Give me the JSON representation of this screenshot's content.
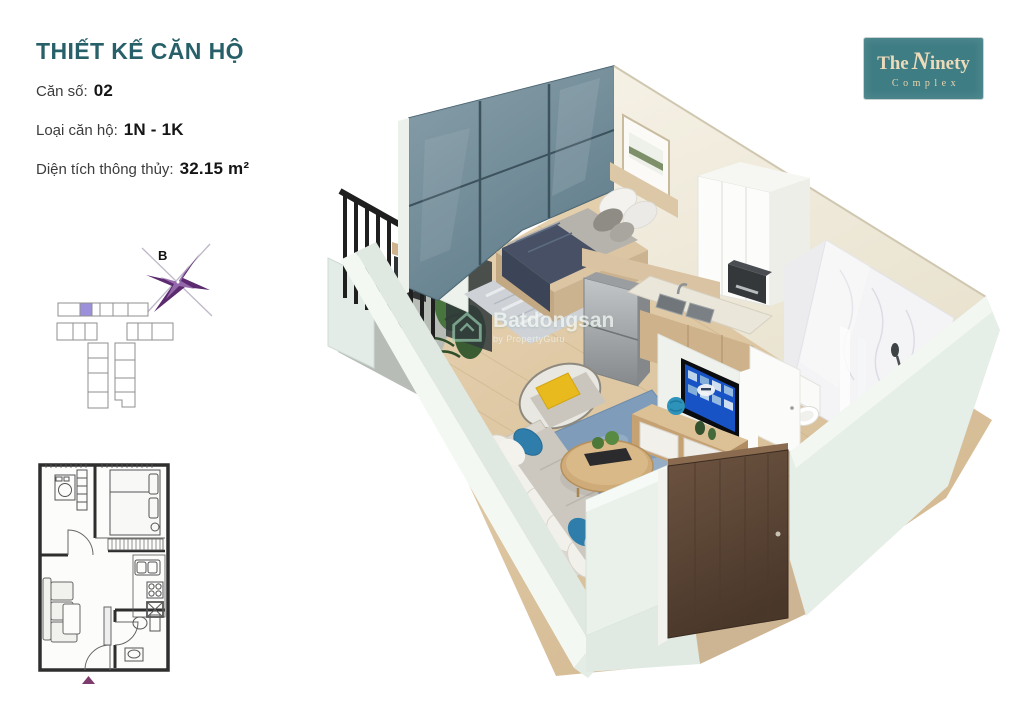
{
  "page": {
    "width": 1024,
    "height": 724,
    "background": "#ffffff"
  },
  "header": {
    "title": "THIẾT KẾ CĂN HỘ",
    "specs": [
      {
        "label": "Căn số:",
        "value": "02"
      },
      {
        "label": "Loại căn hộ:",
        "value": "1N - 1K"
      },
      {
        "label": "Diện tích thông thủy:",
        "value": "32.15 m²"
      }
    ]
  },
  "logo": {
    "word_the": "The",
    "word_ninety_initial": "N",
    "word_ninety_rest": "inety",
    "word_complex": "Complex"
  },
  "key_plan": {
    "compass_label": "B"
  },
  "watermark": {
    "brand": "Batdongsan",
    "byline": "by PropertyGuru"
  },
  "colors": {
    "title_teal": "#28606A",
    "logo_background": "#3F7D84",
    "logo_text_gold": "#ECDBBA",
    "keyplan_highlight_purple": "#9C90DA",
    "compass_purple": "#5C2A6E",
    "entry_arrow_purple": "#7D3C6E",
    "glass_wall": "#75909D",
    "outer_wall_mint": "#E6EFE9",
    "back_wall_cream": "#F2EEE2",
    "floor_wood": "#DFCBAA",
    "living_rug_blue": "#7F9CBA",
    "pillow_yellow": "#E9BA1E",
    "pillow_blue": "#2F7DAB",
    "blanket_navy": "#475064",
    "entrance_door_brown": "#5B4434",
    "tv_screen_blue": "#1853C6"
  }
}
